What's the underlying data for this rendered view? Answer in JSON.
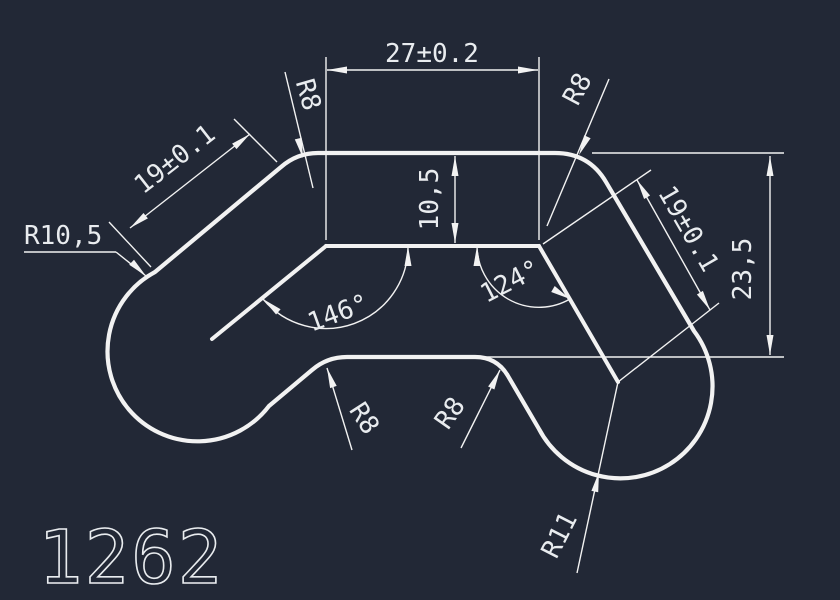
{
  "drawing_number": "1262",
  "colors": {
    "background": "#222836",
    "line": "#f2f2f2",
    "text": "#e9ecef"
  },
  "dimensions": {
    "top_width": "27±0.2",
    "left_arm_length": "19±0.1",
    "right_arm_length": "19±0.1",
    "wall_thickness": "10,5",
    "overall_height": "23,5"
  },
  "angles": {
    "left_bend": "146°",
    "right_bend": "124°"
  },
  "radii": {
    "left_cap": "R10,5",
    "top_left_bend": "R8",
    "top_right_bend": "R8",
    "dip_left_fillet": "R8",
    "dip_right_fillet": "R8",
    "right_cap": "R11"
  }
}
